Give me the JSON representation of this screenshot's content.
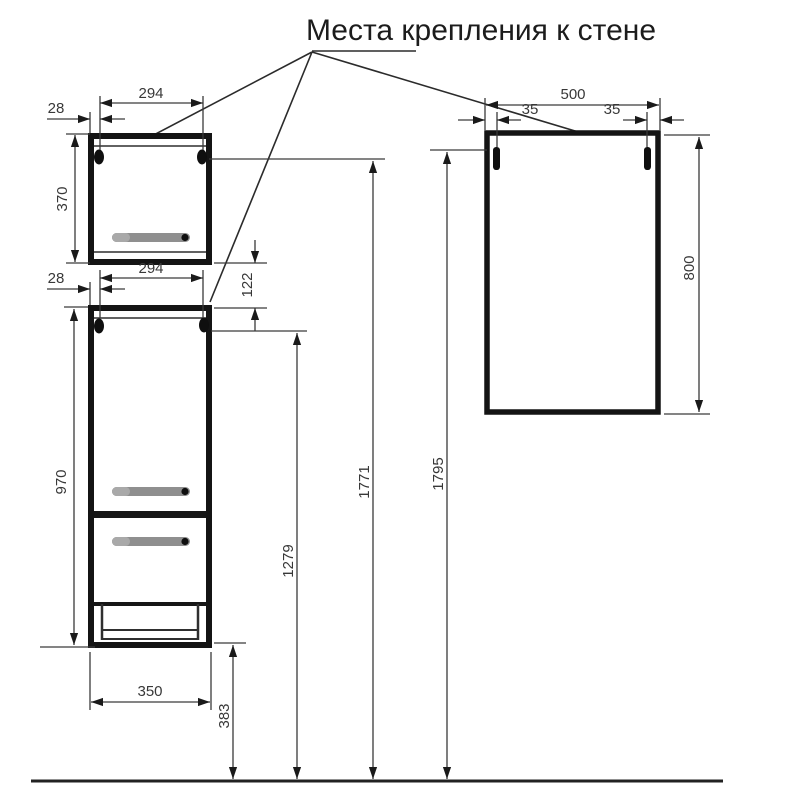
{
  "title": "Места крепления к стене",
  "dims": {
    "upper_cabinet": {
      "mount_spacing": "294",
      "edge_offset": "28",
      "height": "370"
    },
    "lower_cabinet": {
      "mount_spacing": "294",
      "edge_offset": "28",
      "gap_to_upper": "122",
      "height": "970",
      "width": "350",
      "floor_clearance": "383",
      "mount_height": "1279"
    },
    "upper_mount_height": "1771",
    "mirror_mount_height": "1795",
    "mirror": {
      "width": "500",
      "left_slot_offset": "35",
      "right_slot_offset": "35",
      "height": "800"
    }
  }
}
